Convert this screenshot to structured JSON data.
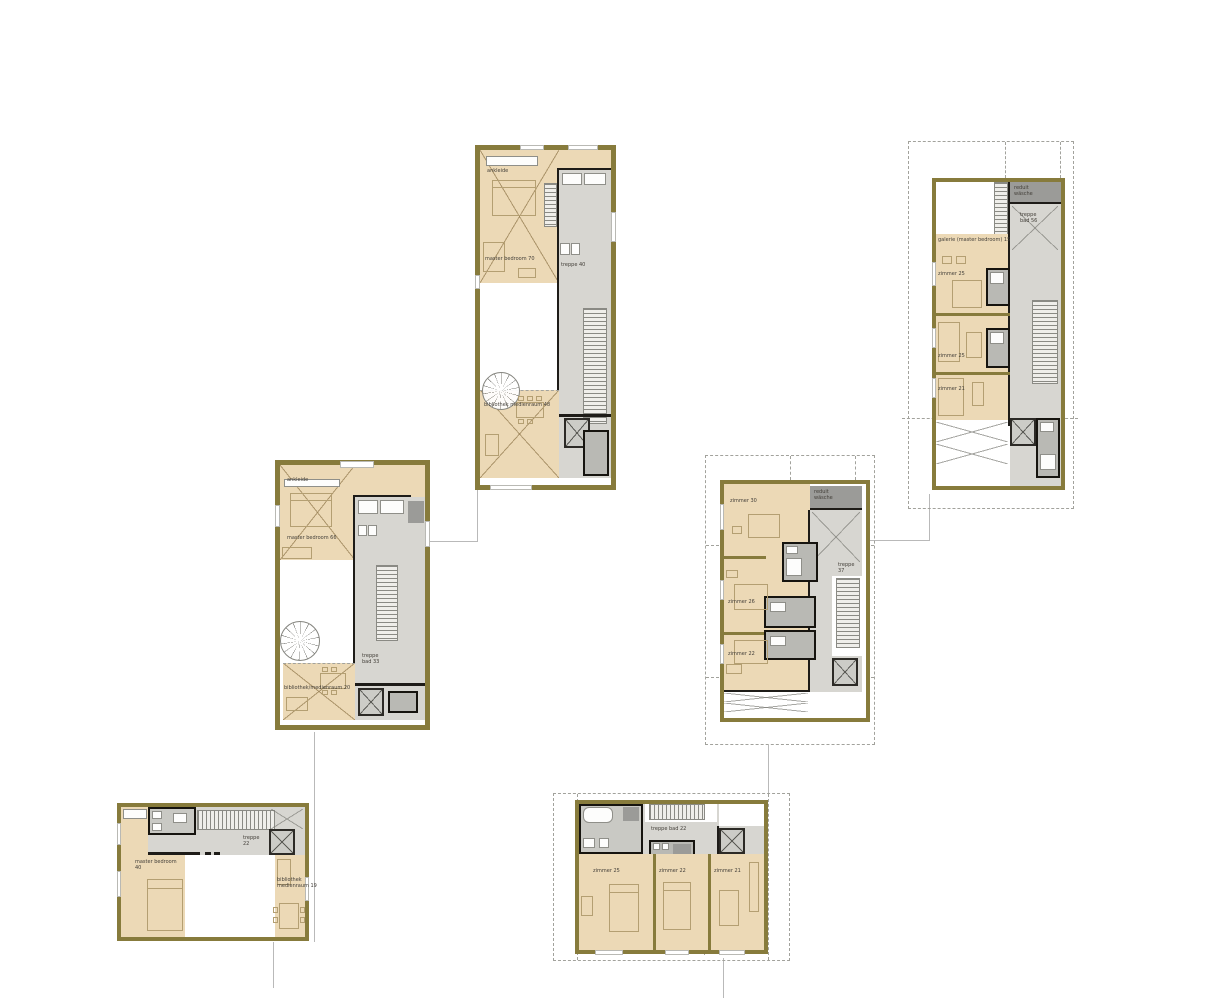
{
  "colors": {
    "wall_olive": "#877b3c",
    "room_tan": "#ecd9b6",
    "core_gray": "#d7d6d1",
    "storage_gray": "#9b9b98",
    "wall_black": "#1e1c18",
    "connector_gray": "#b9b9b9",
    "background": "#ffffff"
  },
  "plans": {
    "plan_top_center": {
      "labels": {
        "ankleide": "ankleide",
        "master_bedroom": "master bedroom 70",
        "treppe": "treppe 40",
        "bibliothek": "bibliothek medienraum 48"
      }
    },
    "plan_top_right": {
      "labels": {
        "reduit": "reduit wäsche",
        "treppe": "treppe bad 56",
        "galerie": "galerie (master bedroom) 15",
        "zimmer_a": "zimmer 25",
        "zimmer_b": "zimmer 25",
        "zimmer_c": "zimmer 21"
      }
    },
    "plan_mid_left": {
      "labels": {
        "ankleide": "ankleide",
        "master_bedroom": "master bedroom 66",
        "treppe": "treppe bad 33",
        "bibliothek": "bibliothek/medienraum 20"
      }
    },
    "plan_mid_right": {
      "labels": {
        "zimmer_a": "zimmer 30",
        "reduit": "reduit wäsche",
        "treppe": "treppe 37",
        "zimmer_b": "zimmer 26",
        "zimmer_c": "zimmer 22"
      }
    },
    "plan_bottom_left": {
      "labels": {
        "master_bedroom": "master bedroom 40",
        "treppe": "treppe 22",
        "bibliothek": "bibliothek medienraum 19"
      }
    },
    "plan_bottom_center": {
      "labels": {
        "treppe": "treppe bad 22",
        "zimmer_a": "zimmer 25",
        "zimmer_b": "zimmer 22",
        "zimmer_c": "zimmer 21"
      }
    }
  }
}
